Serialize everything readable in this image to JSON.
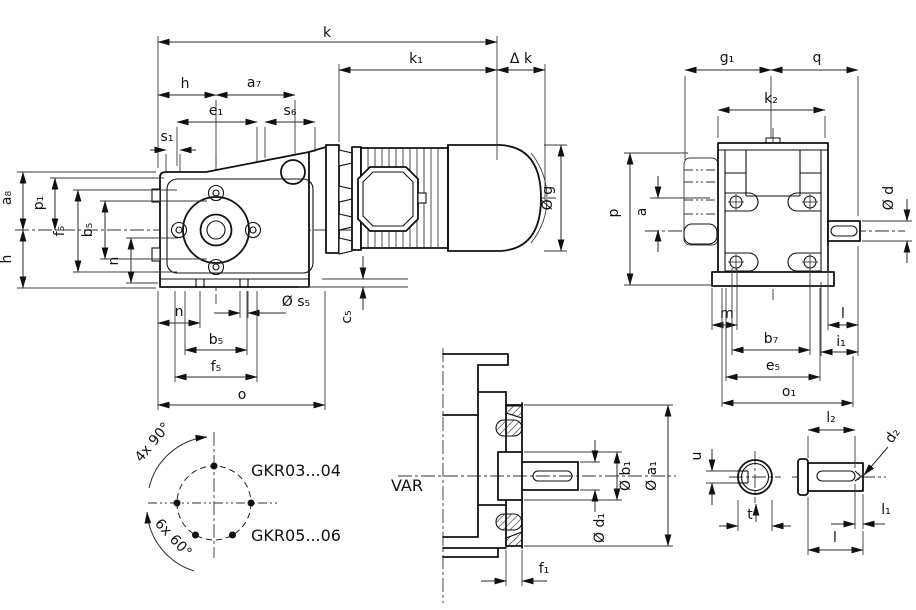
{
  "drawing": {
    "side_view": {
      "k": "k",
      "k1": "k₁",
      "delta_k": "Δ k",
      "h_top": "h",
      "a7": "a₇",
      "e1": "e₁",
      "s6": "s₆",
      "s1": "s₁",
      "a8": "a₈",
      "h_left": "h",
      "p1": "p₁",
      "f5_left": "f₅",
      "b5_left": "b₅",
      "n_left": "n",
      "n_bottom": "n",
      "s5": "Ø s₅",
      "b5_bottom": "b₅",
      "f5_bottom": "f₅",
      "o": "o",
      "c5": "c₅",
      "g": "Ø g"
    },
    "end_view": {
      "g1": "g₁",
      "q": "q",
      "k2": "k₂",
      "p": "p",
      "a": "a",
      "d": "Ø d",
      "m": "m",
      "l": "l",
      "b7": "b₇",
      "i1": "i₁",
      "e5": "e₅",
      "o1": "o₁"
    },
    "bolt_circle": {
      "four_holes": "4x 90°",
      "six_holes": "6x 60°",
      "model_a": "GKR03...04",
      "model_b": "GKR05...06"
    },
    "flange_view": {
      "variant": "VAR",
      "b1": "Ø b₁",
      "a1": "Ø a₁",
      "d1": "Ø d₁",
      "f1": "f₁"
    },
    "shaft_view": {
      "u": "u",
      "t": "t",
      "l2": "l₂",
      "d2": "d₂",
      "l1": "l₁",
      "l": "l"
    }
  }
}
